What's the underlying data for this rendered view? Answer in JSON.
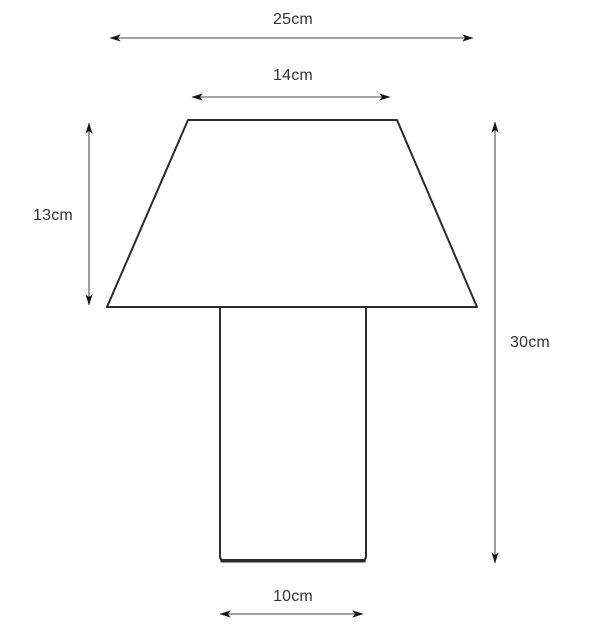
{
  "diagram": {
    "type": "dimension-diagram",
    "description": "Outline drawing of a table lamp (trapezoidal shade on rectangular base) with measurement arrows",
    "unit": "cm",
    "labels": {
      "overall_width": "25cm",
      "shade_top_width": "14cm",
      "shade_height": "13cm",
      "total_height": "30cm",
      "base_width": "10cm"
    },
    "values": {
      "overall_width_cm": 25,
      "shade_top_width_cm": 14,
      "shade_height_cm": 13,
      "total_height_cm": 30,
      "base_width_cm": 10
    },
    "colors": {
      "outline": "#2b2b2b",
      "dimension_line": "#4a4a4a",
      "arrowhead": "#151515",
      "text": "#333333",
      "background": "#ffffff"
    }
  }
}
